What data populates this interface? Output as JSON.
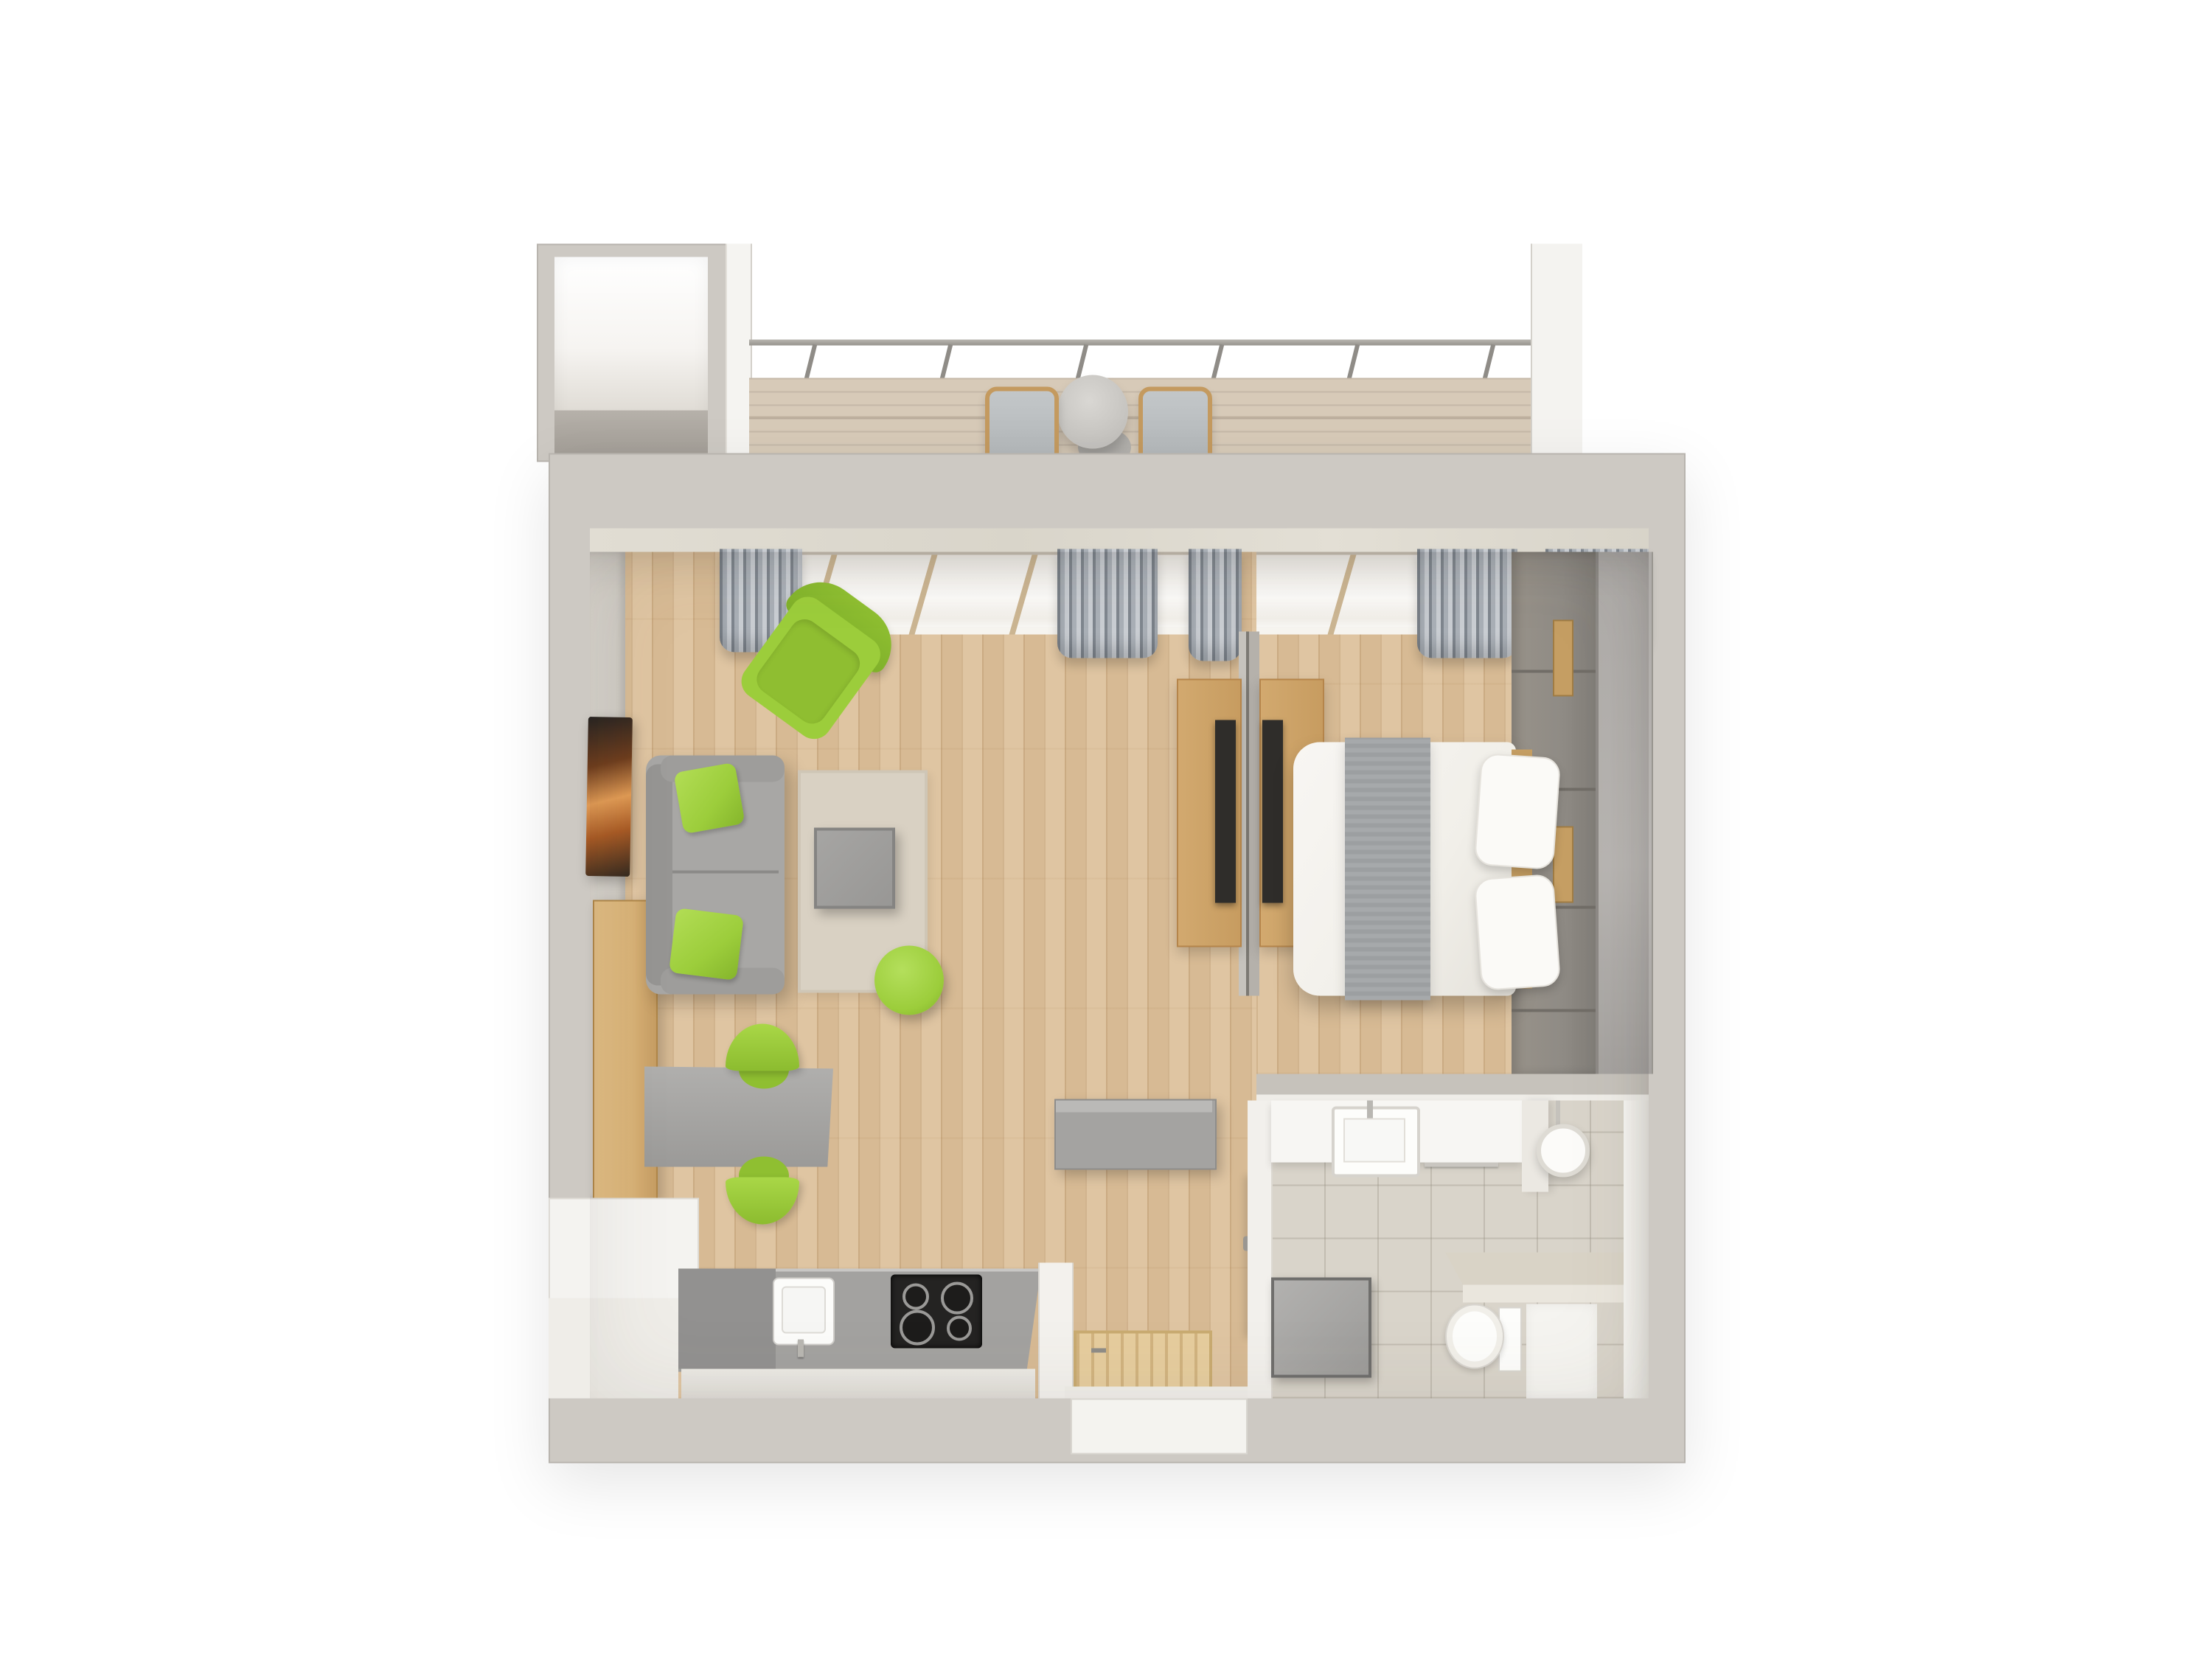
{
  "scene": {
    "kind": "3d-floor-plan-top-view",
    "description": "Top-down 3D render of a one-room apartment with balcony",
    "text_visible": false
  },
  "palette": {
    "page_bg": "#ffffff",
    "wall": "#cdc9c3",
    "wall_edge": "#b8b4ae",
    "marble": "#dedacf",
    "wood_floor": "#ddc19b",
    "deck": "#d7cab8",
    "rug": "#d9d1c3",
    "green": "#9ccd3b",
    "sofa": "#a8a7a5",
    "sofa_dark": "#969593",
    "table_gray": "#989795",
    "curtain_dark": "#7f868e",
    "curtain_light": "#c9cdd2",
    "window_frame": "#cbb592",
    "desk_wood": "#d2a96f",
    "sideboard": "#d8b277",
    "shelf_wood": "#c59e63",
    "chair_wood": "#c49a5f",
    "tv_screen": "#2f2d2a",
    "sunset_hi": "#e09a54",
    "panel": "#8f8b85",
    "wardrobe": "#b1aeab",
    "bed_duvet": "#f1efe9",
    "bed_throw": "#a6a9ab",
    "pillow": "#fbfaf7",
    "dresser": "#a4a3a1",
    "doormat": "#e6cd9e",
    "door_white": "#faf9f6",
    "tile": "#d9d4ca",
    "vanity": "#f7f6f3",
    "fixture_white": "#fdfdfb",
    "counter_beige": "#d9d3c6",
    "shower_white": "#f5f4f0",
    "box_gray": "#9c9b99",
    "kitchen_counter": "#a3a2a0",
    "kitchen_cabinet": "#929190",
    "cooktop": "#242322",
    "sink_white": "#fcfcfa",
    "chrome": "#b9b7b2"
  },
  "rooms": {
    "annex": {
      "label": "Corridor annex",
      "items": [
        "empty corridor fragment"
      ]
    },
    "balcony": {
      "label": "Balcony",
      "items": [
        "wood deck",
        "glass railing with posts",
        "round bistro table",
        "2 outdoor chairs"
      ]
    },
    "living": {
      "label": "Living room",
      "items": [
        "gray sofa",
        "2 green pillows",
        "green armchair",
        "beige rug",
        "gray coffee table",
        "green pouf",
        "gray dining table",
        "2 green chairs",
        "wall TV with sunset screen",
        "wood sideboard",
        "desk with TV on divider"
      ]
    },
    "bedroom": {
      "label": "Bedroom",
      "items": [
        "double bed with white duvet",
        "gray throw blanket",
        "2 white pillows",
        "paneled headboard wall",
        "tall wardrobe",
        "desk with TV on divider",
        "curtained windows"
      ]
    },
    "kitchen": {
      "label": "Kitchen",
      "items": [
        "gray counter",
        "white sink with faucet",
        "black 4-burner cooktop"
      ]
    },
    "hallway": {
      "label": "Hallway",
      "items": [
        "gray dresser",
        "wooden doormat",
        "entry door",
        "bathroom door"
      ]
    },
    "bathroom": {
      "label": "Bathroom",
      "items": [
        "vanity with sink",
        "round mirror light",
        "towel bar",
        "beige counter",
        "wall-hung toilet",
        "shower area",
        "gray shower box"
      ]
    }
  }
}
